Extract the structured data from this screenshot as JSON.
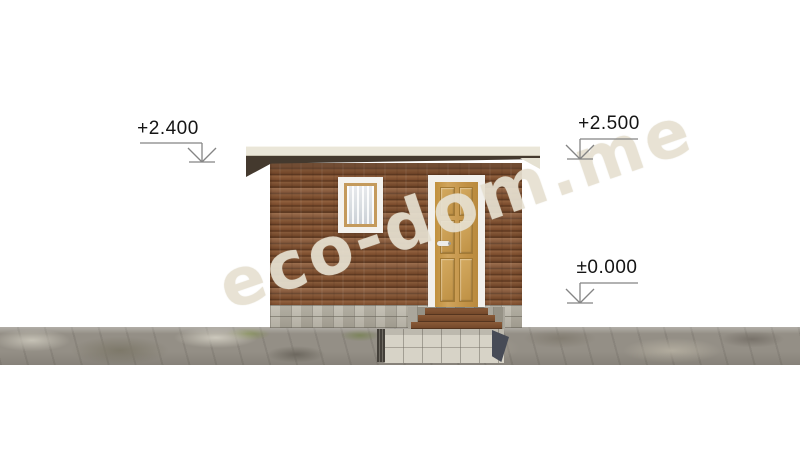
{
  "drawing": {
    "kind": "house front elevation",
    "watermark": {
      "text": "eco-dom.me",
      "color": "#E8E2D2"
    },
    "markers": {
      "roof_left": "+2.400",
      "roof_right": "+2.500",
      "ground": "±0.000"
    },
    "colors": {
      "background": "#FFFFFF",
      "facade_wood": "#7C4E2E",
      "facade_gap": "#5E3A22",
      "roof_slab": "#EAE6D8",
      "roof_underside": "#44392E",
      "trim_white": "#F2F0EC",
      "window_frame_wood": "#C49A5C",
      "curtain": "#DCE0E4",
      "door_wood": "#C59A50",
      "step_tread": "#8A5A38",
      "foundation_stone": "#B3AFA2",
      "ground_rock": "#948F86",
      "concrete_wall": "#D7D3C7",
      "shadow_dark": "#474B56",
      "marker_line": "#858585",
      "marker_text": "#151515"
    }
  }
}
